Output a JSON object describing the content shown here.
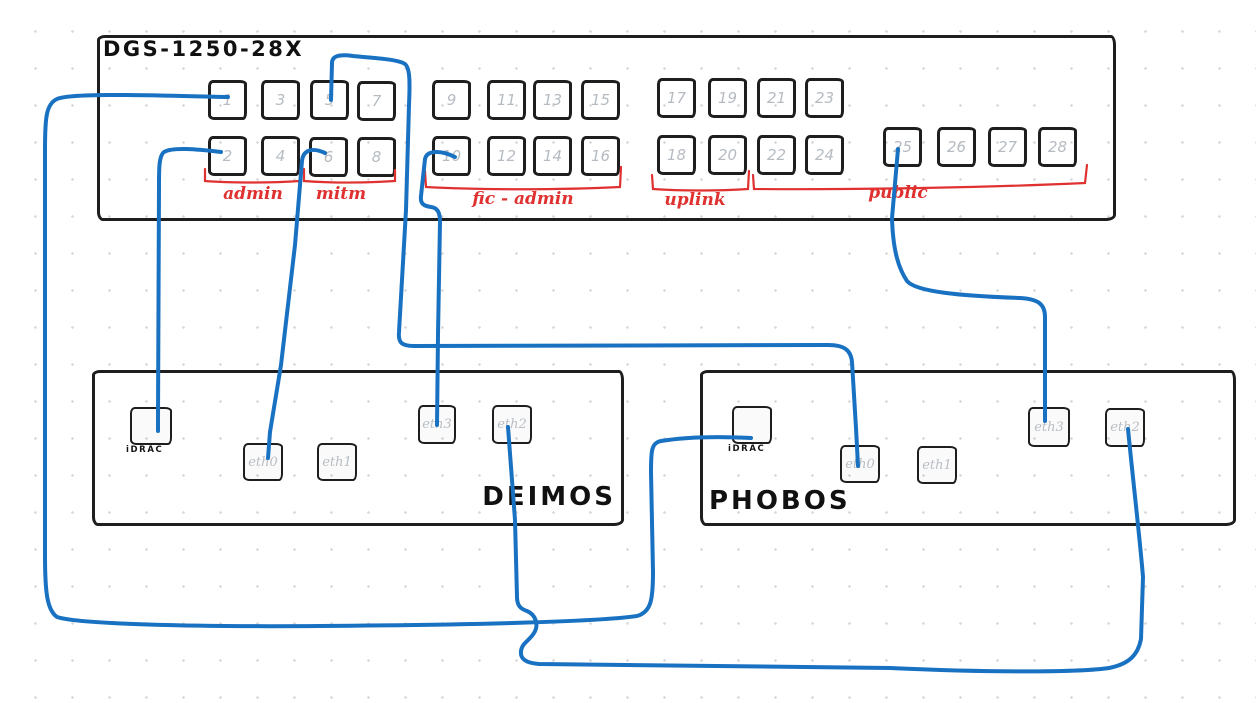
{
  "diagram": {
    "colors": {
      "cable_blue": "#1971c2",
      "annotation_red": "#e03131",
      "ink_black": "#1e1e1e",
      "muted_label_gray": "#b5bbc1",
      "background": "#ffffff"
    },
    "switch": {
      "title": "DGS-1250-28X",
      "box": {
        "x": 97,
        "y": 35,
        "w": 1013,
        "h": 180
      },
      "groups": [
        {
          "id": "admin",
          "label": "admin",
          "ports_covered": "1-4"
        },
        {
          "id": "mitm",
          "label": "mitm",
          "ports_covered": "5-8"
        },
        {
          "id": "fic-admin",
          "label": "fic - admin",
          "ports_covered": "9-16"
        },
        {
          "id": "uplink",
          "label": "uplink",
          "ports_covered": "17-20"
        },
        {
          "id": "public",
          "label": "public",
          "ports_covered": "21-28"
        }
      ],
      "ports": [
        {
          "n": "1",
          "x": 208,
          "y": 80
        },
        {
          "n": "3",
          "x": 261,
          "y": 80
        },
        {
          "n": "5",
          "x": 310,
          "y": 80
        },
        {
          "n": "7",
          "x": 357,
          "y": 81
        },
        {
          "n": "9",
          "x": 432,
          "y": 80
        },
        {
          "n": "11",
          "x": 487,
          "y": 80
        },
        {
          "n": "13",
          "x": 533,
          "y": 80
        },
        {
          "n": "15",
          "x": 581,
          "y": 80
        },
        {
          "n": "17",
          "x": 657,
          "y": 78
        },
        {
          "n": "19",
          "x": 708,
          "y": 78
        },
        {
          "n": "21",
          "x": 757,
          "y": 78
        },
        {
          "n": "23",
          "x": 805,
          "y": 78
        },
        {
          "n": "2",
          "x": 208,
          "y": 136
        },
        {
          "n": "4",
          "x": 261,
          "y": 136
        },
        {
          "n": "6",
          "x": 309,
          "y": 137
        },
        {
          "n": "8",
          "x": 357,
          "y": 137
        },
        {
          "n": "10",
          "x": 432,
          "y": 136
        },
        {
          "n": "12",
          "x": 487,
          "y": 136
        },
        {
          "n": "14",
          "x": 533,
          "y": 136
        },
        {
          "n": "16",
          "x": 581,
          "y": 136
        },
        {
          "n": "18",
          "x": 657,
          "y": 135
        },
        {
          "n": "20",
          "x": 708,
          "y": 135
        },
        {
          "n": "22",
          "x": 757,
          "y": 135
        },
        {
          "n": "24",
          "x": 805,
          "y": 135
        },
        {
          "n": "25",
          "x": 883,
          "y": 127
        },
        {
          "n": "26",
          "x": 937,
          "y": 127
        },
        {
          "n": "27",
          "x": 988,
          "y": 127
        },
        {
          "n": "28",
          "x": 1038,
          "y": 127
        }
      ]
    },
    "brackets": [
      {
        "id": "admin",
        "label": "admin",
        "path": "M205,169 L205,181 C230,183 270,183 300,181 L300,170",
        "label_x": 253,
        "label_y": 184
      },
      {
        "id": "mitm",
        "label": "mitm",
        "path": "M304,169 L304,181 C330,183 363,183 395,181 L395,170",
        "label_x": 341,
        "label_y": 184
      },
      {
        "id": "fic-admin",
        "label": "fic - admin",
        "path": "M425,171 L426,187 C480,190 560,190 620,187 L621,167",
        "label_x": 523,
        "label_y": 189
      },
      {
        "id": "uplink",
        "label": "uplink",
        "path": "M652,175 L653,189 C680,191 720,191 748,189 L749,171",
        "label_x": 695,
        "label_y": 190
      },
      {
        "id": "public",
        "label": "public",
        "path": "M753,175 L754,189 C860,190 1000,187 1085,183 L1087,165",
        "label_x": 898,
        "label_y": 183
      }
    ],
    "servers": [
      {
        "name": "DEIMOS",
        "box": {
          "x": 92,
          "y": 370,
          "w": 526,
          "h": 150
        },
        "name_style": {
          "left": 468,
          "top": 482,
          "width": 148,
          "align": "right"
        },
        "ports": [
          {
            "label": "iDRAC",
            "x": 130,
            "y": 407,
            "w": 42,
            "h": 38,
            "label_pos": "below"
          },
          {
            "label": "eth0",
            "x": 243,
            "y": 443,
            "w": 40,
            "h": 38,
            "label_pos": "inside"
          },
          {
            "label": "eth1",
            "x": 317,
            "y": 443,
            "w": 40,
            "h": 38,
            "label_pos": "inside"
          },
          {
            "label": "eth3",
            "x": 418,
            "y": 405,
            "w": 38,
            "h": 39,
            "label_pos": "inside"
          },
          {
            "label": "eth2",
            "x": 492,
            "y": 405,
            "w": 40,
            "h": 39,
            "label_pos": "inside"
          }
        ]
      },
      {
        "name": "PHOBOS",
        "box": {
          "x": 700,
          "y": 370,
          "w": 530,
          "h": 150
        },
        "name_style": {
          "left": 709,
          "top": 486,
          "width": 160,
          "align": "left"
        },
        "ports": [
          {
            "label": "iDRAC",
            "x": 732,
            "y": 406,
            "w": 40,
            "h": 38,
            "label_pos": "below"
          },
          {
            "label": "eth0",
            "x": 840,
            "y": 445,
            "w": 40,
            "h": 38,
            "label_pos": "inside"
          },
          {
            "label": "eth1",
            "x": 917,
            "y": 446,
            "w": 40,
            "h": 38,
            "label_pos": "inside"
          },
          {
            "label": "eth3",
            "x": 1028,
            "y": 407,
            "w": 42,
            "h": 40,
            "label_pos": "inside"
          },
          {
            "label": "eth2",
            "x": 1105,
            "y": 408,
            "w": 40,
            "h": 39,
            "label_pos": "inside"
          }
        ]
      }
    ],
    "cables": [
      {
        "id": "switch-port-1--phobos-idrac",
        "from": "switch port 1",
        "to": "PHOBOS iDRAC",
        "path": "M228,97 C170,96 72,92 57,99 C46,104 45,118 45,150 L45,555 C45,592 47,610 57,617 C78,624 190,627 320,626 C460,625 598,622 637,616 C651,612 653,600 653,572 L651,472 C651,452 651,443 661,441 C692,436 731,437 751,438"
      },
      {
        "id": "switch-port-2--deimos-idrac",
        "from": "switch port 2",
        "to": "DEIMOS iDRAC",
        "path": "M221,152 C196,149 172,147 164,152 C159,156 159,168 159,185 L158,420 L158,431"
      },
      {
        "id": "switch-port-5--phobos-eth0",
        "from": "switch port 5",
        "to": "PHOBOS eth0",
        "path": "M331,100 L332,63 C332,56 339,54 353,56 C372,58 398,59 405,64 C410,68 410,82 409,105 L406,210 L399,332 C398,343 402,346 414,346 L828,345 C844,345 851,350 852,362 L856,428 L858,466"
      },
      {
        "id": "switch-port-6--deimos-eth0",
        "from": "switch port 6",
        "to": "DEIMOS eth0",
        "path": "M325,153 C312,147 303,150 302,161 L295,245 L281,365 L270,432 L268,458"
      },
      {
        "id": "switch-port-10--deimos-eth3",
        "from": "switch port 10",
        "to": "DEIMOS eth3",
        "path": "M455,157 C441,150 427,150 425,159 L421,196 C420,204 424,206 431,207 C438,208 440,213 440,222 L438,335 L437,425"
      },
      {
        "id": "switch-port-25--phobos-eth3",
        "from": "switch port 25",
        "to": "PHOBOS eth3",
        "path": "M898,149 L892,218 C893,252 899,269 907,281 C916,292 962,296 1020,298 C1038,299 1045,304 1045,317 L1045,421"
      },
      {
        "id": "deimos-eth2--phobos-eth2",
        "from": "DEIMOS eth2",
        "to": "PHOBOS eth2",
        "path": "M508,427 L515,520 L517,597 C517,606 521,609 527,611 C536,615 539,625 534,633 C529,641 522,643 521,651 C520,659 526,663 539,664 L890,668 C1000,673 1082,672 1109,668 C1129,664 1138,655 1141,639 L1143,577 C1140,540 1133,480 1128,429"
      }
    ]
  }
}
